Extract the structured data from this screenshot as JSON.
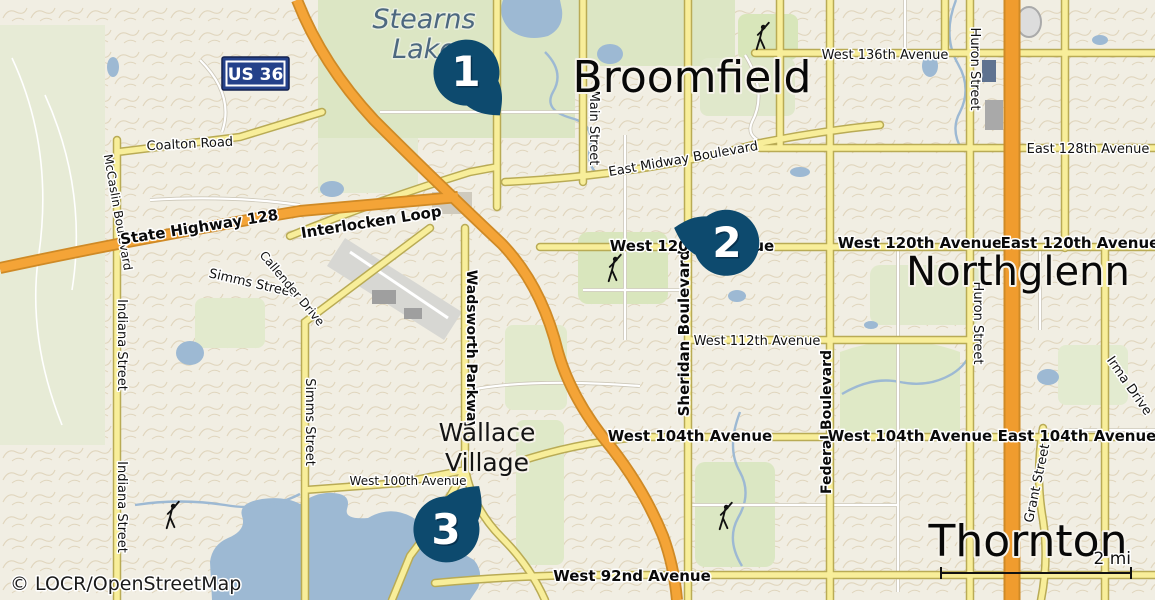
{
  "attribution": "© LOCR/OpenStreetMap",
  "scale": {
    "label": "2 mi"
  },
  "route_badge": {
    "label": "US 36"
  },
  "cities": {
    "broomfield": "Broomfield",
    "northglenn": "Northglenn",
    "thornton": "Thornton"
  },
  "places": {
    "stearns_lake": {
      "line1": "Stearns",
      "line2": "Lake"
    },
    "wallace_village": {
      "line1": "Wallace",
      "line2": "Village"
    }
  },
  "streets": {
    "coalton": "Coalton Road",
    "mccaslin": "McCaslin Boulevard",
    "state_highway_128": "State Highway 128",
    "interlocken": "Interlocken Loop",
    "simms": "Simms Street",
    "callender": "Callender Drive",
    "indiana": "Indiana Street",
    "wadsworth": "Wadsworth Parkway",
    "main": "Main Street",
    "midway": "East Midway Boulevard",
    "sheridan": "Sheridan Boulevard",
    "federal": "Federal Boulevard",
    "huron": "Huron Street",
    "grant": "Grant Street",
    "irma": "Irma Drive",
    "w136": "West 136th Avenue",
    "e128": "East 128th Avenue",
    "w120": "West 120th Avenue",
    "e120": "East 120th Avenue",
    "w112": "West 112th Avenue",
    "w104": "West 104th Avenue",
    "e104": "East 104th Avenue",
    "w100": "West 100th Avenue",
    "w92": "West 92nd Avenue"
  },
  "markers": [
    {
      "number": "1"
    },
    {
      "number": "2"
    },
    {
      "number": "3"
    }
  ],
  "colors": {
    "marker": "#0d4a6e",
    "badge_blue": "#24418a",
    "highway_orange": "#f4a437",
    "motorway_orange": "#f09c2e",
    "road_yellow": "#f8ee9a",
    "water": "#9db9d3",
    "land": "#f1eee3",
    "greenspace": "#dce6c4"
  }
}
